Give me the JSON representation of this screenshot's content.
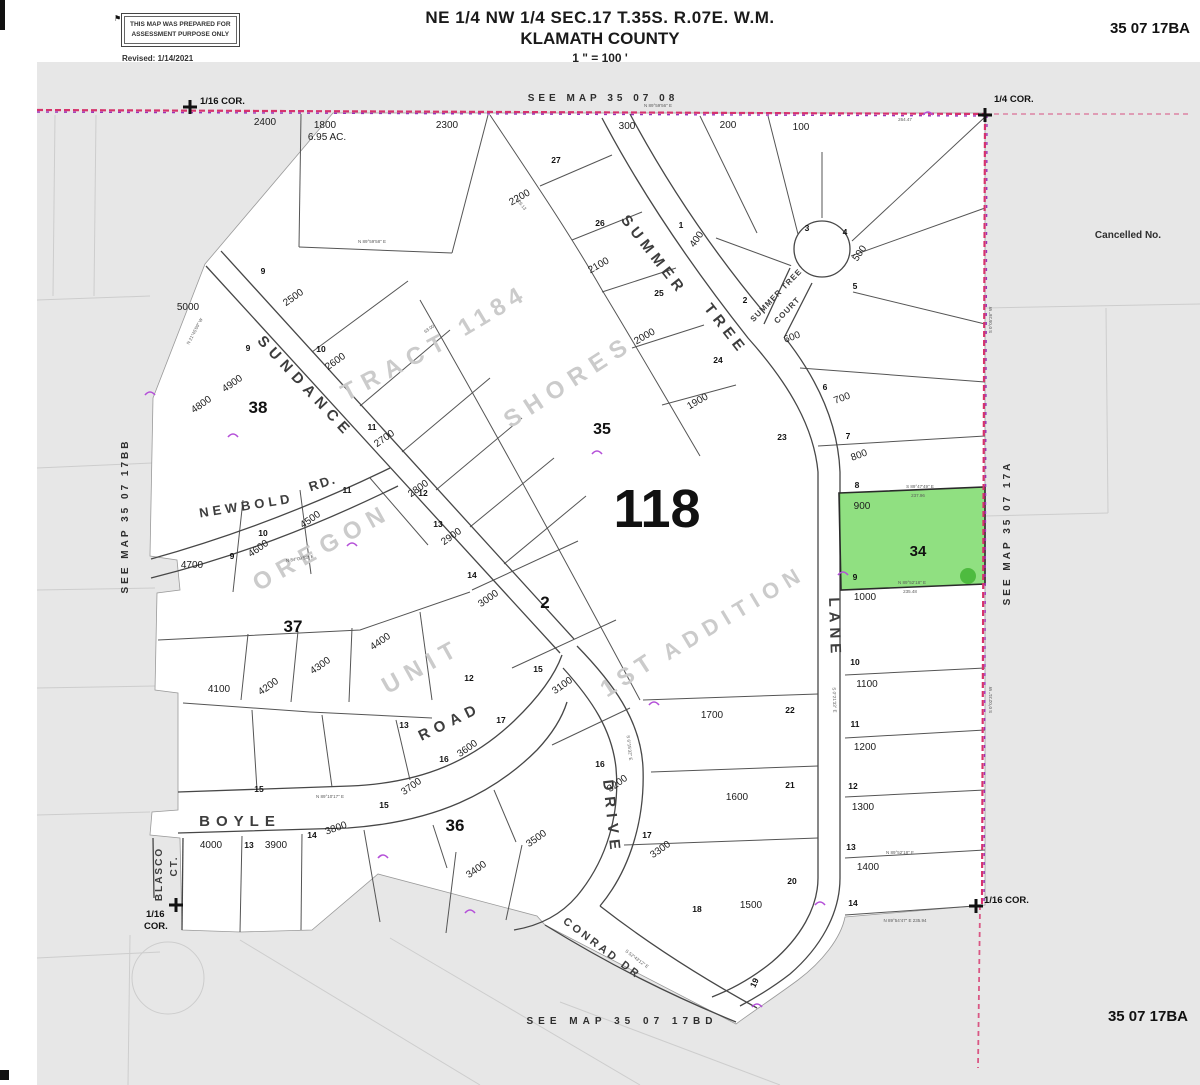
{
  "header": {
    "disclaimer_line1": "THIS MAP WAS PREPARED FOR",
    "disclaimer_line2": "ASSESSMENT PURPOSE ONLY",
    "revised": "Revised: 1/14/2021",
    "flag_icon": "⚑",
    "title_line1": "NE 1/4 NW 1/4 SEC.17 T.35S. R.07E. W.M.",
    "title_line2": "KLAMATH COUNTY",
    "scale": "1 \" = 100 '",
    "map_id": "35 07 17BA"
  },
  "footer": {
    "map_id": "35 07 17BA"
  },
  "highlight": {
    "taxlot": "900",
    "block": "34",
    "color": "#74d862",
    "edge": "#2a2a2a"
  },
  "colors": {
    "sheet": "#e7e7e7",
    "boundary_pink": "#d6336c",
    "boundary_purple": "#9b30b8",
    "line": "#4a4a4a"
  },
  "map_labels": {
    "roads": [
      {
        "t": "SUNDANCE",
        "x": 302,
        "y": 390,
        "r": 47,
        "s": 15,
        "ls": 6
      },
      {
        "t": "ROAD",
        "x": 452,
        "y": 726,
        "r": -26,
        "s": 15,
        "ls": 6
      },
      {
        "t": "NEWBOLD",
        "x": 247,
        "y": 510,
        "r": -9,
        "s": 13,
        "ls": 4
      },
      {
        "t": "RD.",
        "x": 324,
        "y": 487,
        "r": -18,
        "s": 13,
        "ls": 2
      },
      {
        "t": "BOYLE",
        "x": 240,
        "y": 826,
        "r": 0,
        "s": 15,
        "ls": 6
      },
      {
        "t": "BLASCO",
        "x": 162,
        "y": 874,
        "r": -90,
        "s": 10,
        "ls": 2
      },
      {
        "t": "CT.",
        "x": 177,
        "y": 866,
        "r": -90,
        "s": 10,
        "ls": 2
      },
      {
        "t": "DRIVE",
        "x": 607,
        "y": 818,
        "r": 84,
        "s": 15,
        "ls": 6
      },
      {
        "t": "CONRAD  DR",
        "x": 600,
        "y": 951,
        "r": 37,
        "s": 11,
        "ls": 3
      },
      {
        "t": "SUMMER",
        "x": 650,
        "y": 258,
        "r": 52,
        "s": 15,
        "ls": 5
      },
      {
        "t": "TREE",
        "x": 722,
        "y": 332,
        "r": 52,
        "s": 15,
        "ls": 5
      },
      {
        "t": "LANE",
        "x": 830,
        "y": 628,
        "r": 88,
        "s": 15,
        "ls": 5
      },
      {
        "t": "SUMMER  TREE",
        "x": 778,
        "y": 297,
        "r": -46,
        "s": 8,
        "ls": 1
      },
      {
        "t": "COURT",
        "x": 789,
        "y": 312,
        "r": -46,
        "s": 8,
        "ls": 1
      }
    ],
    "ghost": [
      {
        "t": "1184",
        "x": 497,
        "y": 317,
        "r": -31,
        "s": 24,
        "ls": 6
      },
      {
        "t": "TRACT",
        "x": 400,
        "y": 373,
        "r": -28,
        "s": 24,
        "ls": 8
      },
      {
        "t": "SHORES",
        "x": 573,
        "y": 388,
        "r": -33,
        "s": 24,
        "ls": 8
      },
      {
        "t": "OREGON",
        "x": 326,
        "y": 554,
        "r": -29,
        "s": 24,
        "ls": 8
      },
      {
        "t": "UNIT",
        "x": 426,
        "y": 673,
        "r": -29,
        "s": 24,
        "ls": 8
      },
      {
        "t": "1ST",
        "x": 633,
        "y": 681,
        "r": -33,
        "s": 24,
        "ls": 6
      },
      {
        "t": "ADDITION",
        "x": 738,
        "y": 619,
        "r": -31,
        "s": 22,
        "ls": 7
      }
    ],
    "blocks": [
      {
        "t": "38",
        "x": 258,
        "y": 413,
        "s": 17
      },
      {
        "t": "37",
        "x": 293,
        "y": 632,
        "s": 17
      },
      {
        "t": "36",
        "x": 455,
        "y": 831,
        "s": 17
      },
      {
        "t": "35",
        "x": 602,
        "y": 434,
        "s": 16
      },
      {
        "t": "2",
        "x": 545,
        "y": 608,
        "s": 17
      },
      {
        "t": "34",
        "x": 918,
        "y": 556,
        "s": 15
      },
      {
        "t": "118",
        "x": 657,
        "y": 527,
        "s": 54
      }
    ],
    "lots": [
      {
        "t": "2400",
        "x": 265,
        "y": 125
      },
      {
        "t": "1800",
        "x": 325,
        "y": 128
      },
      {
        "t": "6.95 AC.",
        "x": 327,
        "y": 140,
        "s": 7.5
      },
      {
        "t": "2300",
        "x": 447,
        "y": 128
      },
      {
        "t": "300",
        "x": 627,
        "y": 129
      },
      {
        "t": "200",
        "x": 728,
        "y": 128
      },
      {
        "t": "100",
        "x": 801,
        "y": 130
      },
      {
        "t": "2200",
        "x": 521,
        "y": 200,
        "r": -30
      },
      {
        "t": "2100",
        "x": 600,
        "y": 268,
        "r": -30
      },
      {
        "t": "2000",
        "x": 646,
        "y": 339,
        "r": -30
      },
      {
        "t": "1900",
        "x": 699,
        "y": 404,
        "r": -30
      },
      {
        "t": "2500",
        "x": 295,
        "y": 300,
        "r": -35
      },
      {
        "t": "2600",
        "x": 337,
        "y": 364,
        "r": -35
      },
      {
        "t": "2700",
        "x": 386,
        "y": 441,
        "r": -35
      },
      {
        "t": "2800",
        "x": 420,
        "y": 491,
        "r": -35
      },
      {
        "t": "2900",
        "x": 453,
        "y": 539,
        "r": -35
      },
      {
        "t": "3000",
        "x": 490,
        "y": 601,
        "r": -35
      },
      {
        "t": "3100",
        "x": 564,
        "y": 688,
        "r": -35
      },
      {
        "t": "3200",
        "x": 619,
        "y": 786,
        "r": -35
      },
      {
        "t": "3300",
        "x": 662,
        "y": 852,
        "r": -35
      },
      {
        "t": "3400",
        "x": 478,
        "y": 872,
        "r": -35
      },
      {
        "t": "3500",
        "x": 538,
        "y": 841,
        "r": -35
      },
      {
        "t": "3600",
        "x": 469,
        "y": 751,
        "r": -35
      },
      {
        "t": "3700",
        "x": 413,
        "y": 789,
        "r": -35
      },
      {
        "t": "3800",
        "x": 337,
        "y": 831,
        "r": -20
      },
      {
        "t": "3900",
        "x": 276,
        "y": 848
      },
      {
        "t": "4000",
        "x": 211,
        "y": 848
      },
      {
        "t": "4100",
        "x": 219,
        "y": 692
      },
      {
        "t": "4200",
        "x": 270,
        "y": 689,
        "r": -35
      },
      {
        "t": "4300",
        "x": 322,
        "y": 668,
        "r": -35
      },
      {
        "t": "4400",
        "x": 382,
        "y": 644,
        "r": -35
      },
      {
        "t": "4500",
        "x": 312,
        "y": 522,
        "r": -35
      },
      {
        "t": "4600",
        "x": 260,
        "y": 551,
        "r": -35
      },
      {
        "t": "4700",
        "x": 192,
        "y": 568
      },
      {
        "t": "4800",
        "x": 203,
        "y": 407,
        "r": -35
      },
      {
        "t": "4900",
        "x": 234,
        "y": 386,
        "r": -35
      },
      {
        "t": "5000",
        "x": 188,
        "y": 310
      },
      {
        "t": "1700",
        "x": 712,
        "y": 718
      },
      {
        "t": "1600",
        "x": 737,
        "y": 800
      },
      {
        "t": "1500",
        "x": 751,
        "y": 908
      },
      {
        "t": "1400",
        "x": 868,
        "y": 870
      },
      {
        "t": "1300",
        "x": 863,
        "y": 810
      },
      {
        "t": "1200",
        "x": 865,
        "y": 750
      },
      {
        "t": "1100",
        "x": 867,
        "y": 687
      },
      {
        "t": "1000",
        "x": 865,
        "y": 600
      },
      {
        "t": "900",
        "x": 862,
        "y": 509
      },
      {
        "t": "800",
        "x": 860,
        "y": 458,
        "r": -20
      },
      {
        "t": "700",
        "x": 843,
        "y": 401,
        "r": -20
      },
      {
        "t": "600",
        "x": 793,
        "y": 340,
        "r": -20
      },
      {
        "t": "500",
        "x": 862,
        "y": 255,
        "r": -55
      },
      {
        "t": "400",
        "x": 699,
        "y": 241,
        "r": -55
      }
    ],
    "lot_numbers": [
      {
        "t": "9",
        "x": 263,
        "y": 274
      },
      {
        "t": "9",
        "x": 248,
        "y": 351
      },
      {
        "t": "10",
        "x": 321,
        "y": 352
      },
      {
        "t": "11",
        "x": 372,
        "y": 430
      },
      {
        "t": "12",
        "x": 423,
        "y": 496
      },
      {
        "t": "13",
        "x": 438,
        "y": 527
      },
      {
        "t": "14",
        "x": 472,
        "y": 578
      },
      {
        "t": "15",
        "x": 538,
        "y": 672
      },
      {
        "t": "16",
        "x": 600,
        "y": 767
      },
      {
        "t": "17",
        "x": 647,
        "y": 838
      },
      {
        "t": "27",
        "x": 556,
        "y": 163
      },
      {
        "t": "26",
        "x": 600,
        "y": 226
      },
      {
        "t": "25",
        "x": 659,
        "y": 296
      },
      {
        "t": "24",
        "x": 718,
        "y": 363
      },
      {
        "t": "23",
        "x": 782,
        "y": 440
      },
      {
        "t": "22",
        "x": 790,
        "y": 713
      },
      {
        "t": "21",
        "x": 790,
        "y": 788
      },
      {
        "t": "20",
        "x": 792,
        "y": 884
      },
      {
        "t": "19",
        "x": 757,
        "y": 984,
        "r": -65
      },
      {
        "t": "18",
        "x": 697,
        "y": 912
      },
      {
        "t": "1",
        "x": 681,
        "y": 228
      },
      {
        "t": "2",
        "x": 745,
        "y": 303
      },
      {
        "t": "3",
        "x": 807,
        "y": 231
      },
      {
        "t": "4",
        "x": 845,
        "y": 235
      },
      {
        "t": "5",
        "x": 855,
        "y": 289
      },
      {
        "t": "6",
        "x": 825,
        "y": 390
      },
      {
        "t": "7",
        "x": 848,
        "y": 439
      },
      {
        "t": "8",
        "x": 857,
        "y": 488
      },
      {
        "t": "9",
        "x": 855,
        "y": 580
      },
      {
        "t": "10",
        "x": 855,
        "y": 665
      },
      {
        "t": "11",
        "x": 855,
        "y": 727
      },
      {
        "t": "12",
        "x": 853,
        "y": 789
      },
      {
        "t": "13",
        "x": 851,
        "y": 850
      },
      {
        "t": "14",
        "x": 853,
        "y": 906
      },
      {
        "t": "9",
        "x": 232,
        "y": 559
      },
      {
        "t": "10",
        "x": 263,
        "y": 536
      },
      {
        "t": "11",
        "x": 347,
        "y": 493
      },
      {
        "t": "12",
        "x": 469,
        "y": 681
      },
      {
        "t": "13",
        "x": 404,
        "y": 728
      },
      {
        "t": "14",
        "x": 312,
        "y": 838
      },
      {
        "t": "15",
        "x": 259,
        "y": 792
      },
      {
        "t": "15",
        "x": 384,
        "y": 808
      },
      {
        "t": "16",
        "x": 444,
        "y": 762
      },
      {
        "t": "17",
        "x": 501,
        "y": 723
      },
      {
        "t": "13",
        "x": 249,
        "y": 848
      }
    ],
    "bearings": [
      {
        "t": "N 89°59'58\" E",
        "x": 372,
        "y": 243
      },
      {
        "t": "N 89°59'56\" E",
        "x": 658,
        "y": 107
      },
      {
        "t": "264.47",
        "x": 905,
        "y": 121
      },
      {
        "t": "S 0°05'26\" W",
        "x": 992,
        "y": 320,
        "r": -90
      },
      {
        "t": "S 0°02'31\" W",
        "x": 992,
        "y": 700,
        "r": -90
      },
      {
        "t": "S 89°47'49\" E",
        "x": 920,
        "y": 488
      },
      {
        "t": "237.96",
        "x": 918,
        "y": 497
      },
      {
        "t": "N 89°52'18\" E",
        "x": 912,
        "y": 584
      },
      {
        "t": "235.48",
        "x": 910,
        "y": 593
      },
      {
        "t": "N 89°52'18\" E",
        "x": 900,
        "y": 854
      },
      {
        "t": "N 89°54'47\" E  235.94",
        "x": 905,
        "y": 922
      },
      {
        "t": "N 21°45'09\" W",
        "x": 196,
        "y": 332,
        "r": -62
      },
      {
        "t": "N 84°09'53\" E",
        "x": 300,
        "y": 560,
        "r": -9
      },
      {
        "t": "S 6°15'32\" E",
        "x": 628,
        "y": 748,
        "r": 84
      },
      {
        "t": "S 0°21'33\" E",
        "x": 833,
        "y": 700,
        "r": 88
      },
      {
        "t": "S 52°43'12\" E",
        "x": 636,
        "y": 960,
        "r": 37
      },
      {
        "t": "N 89°10'17\" E",
        "x": 330,
        "y": 798
      },
      {
        "t": "126.13",
        "x": 520,
        "y": 205,
        "r": 52
      },
      {
        "t": "63.00",
        "x": 430,
        "y": 330,
        "r": -35
      }
    ],
    "corners": [
      {
        "t": "1/16 COR.",
        "x": 200,
        "y": 104,
        "a": "start"
      },
      {
        "t": "1/4 COR.",
        "x": 994,
        "y": 102,
        "a": "start"
      },
      {
        "t": "1/16 COR.",
        "x": 984,
        "y": 903,
        "a": "start"
      },
      {
        "t": "1/16",
        "x": 146,
        "y": 917,
        "a": "start"
      },
      {
        "t": "COR.",
        "x": 144,
        "y": 929,
        "a": "start"
      }
    ],
    "seemaps": [
      {
        "t": "SEE   MAP   35   07   08",
        "x": 603,
        "y": 101,
        "s": 10,
        "ls": 4
      },
      {
        "t": "SEE   MAP   35   07   17BD",
        "x": 622,
        "y": 1024,
        "s": 10,
        "ls": 5
      },
      {
        "t": "SEE  MAP  35  07  17A",
        "x": 1010,
        "y": 533,
        "r": -90,
        "s": 10,
        "ls": 3
      },
      {
        "t": "SEE  MAP  35  07  17BB",
        "x": 128,
        "y": 516,
        "r": -90,
        "s": 10,
        "ls": 3
      },
      {
        "t": "Cancelled No.",
        "x": 1128,
        "y": 238,
        "s": 9
      }
    ]
  }
}
